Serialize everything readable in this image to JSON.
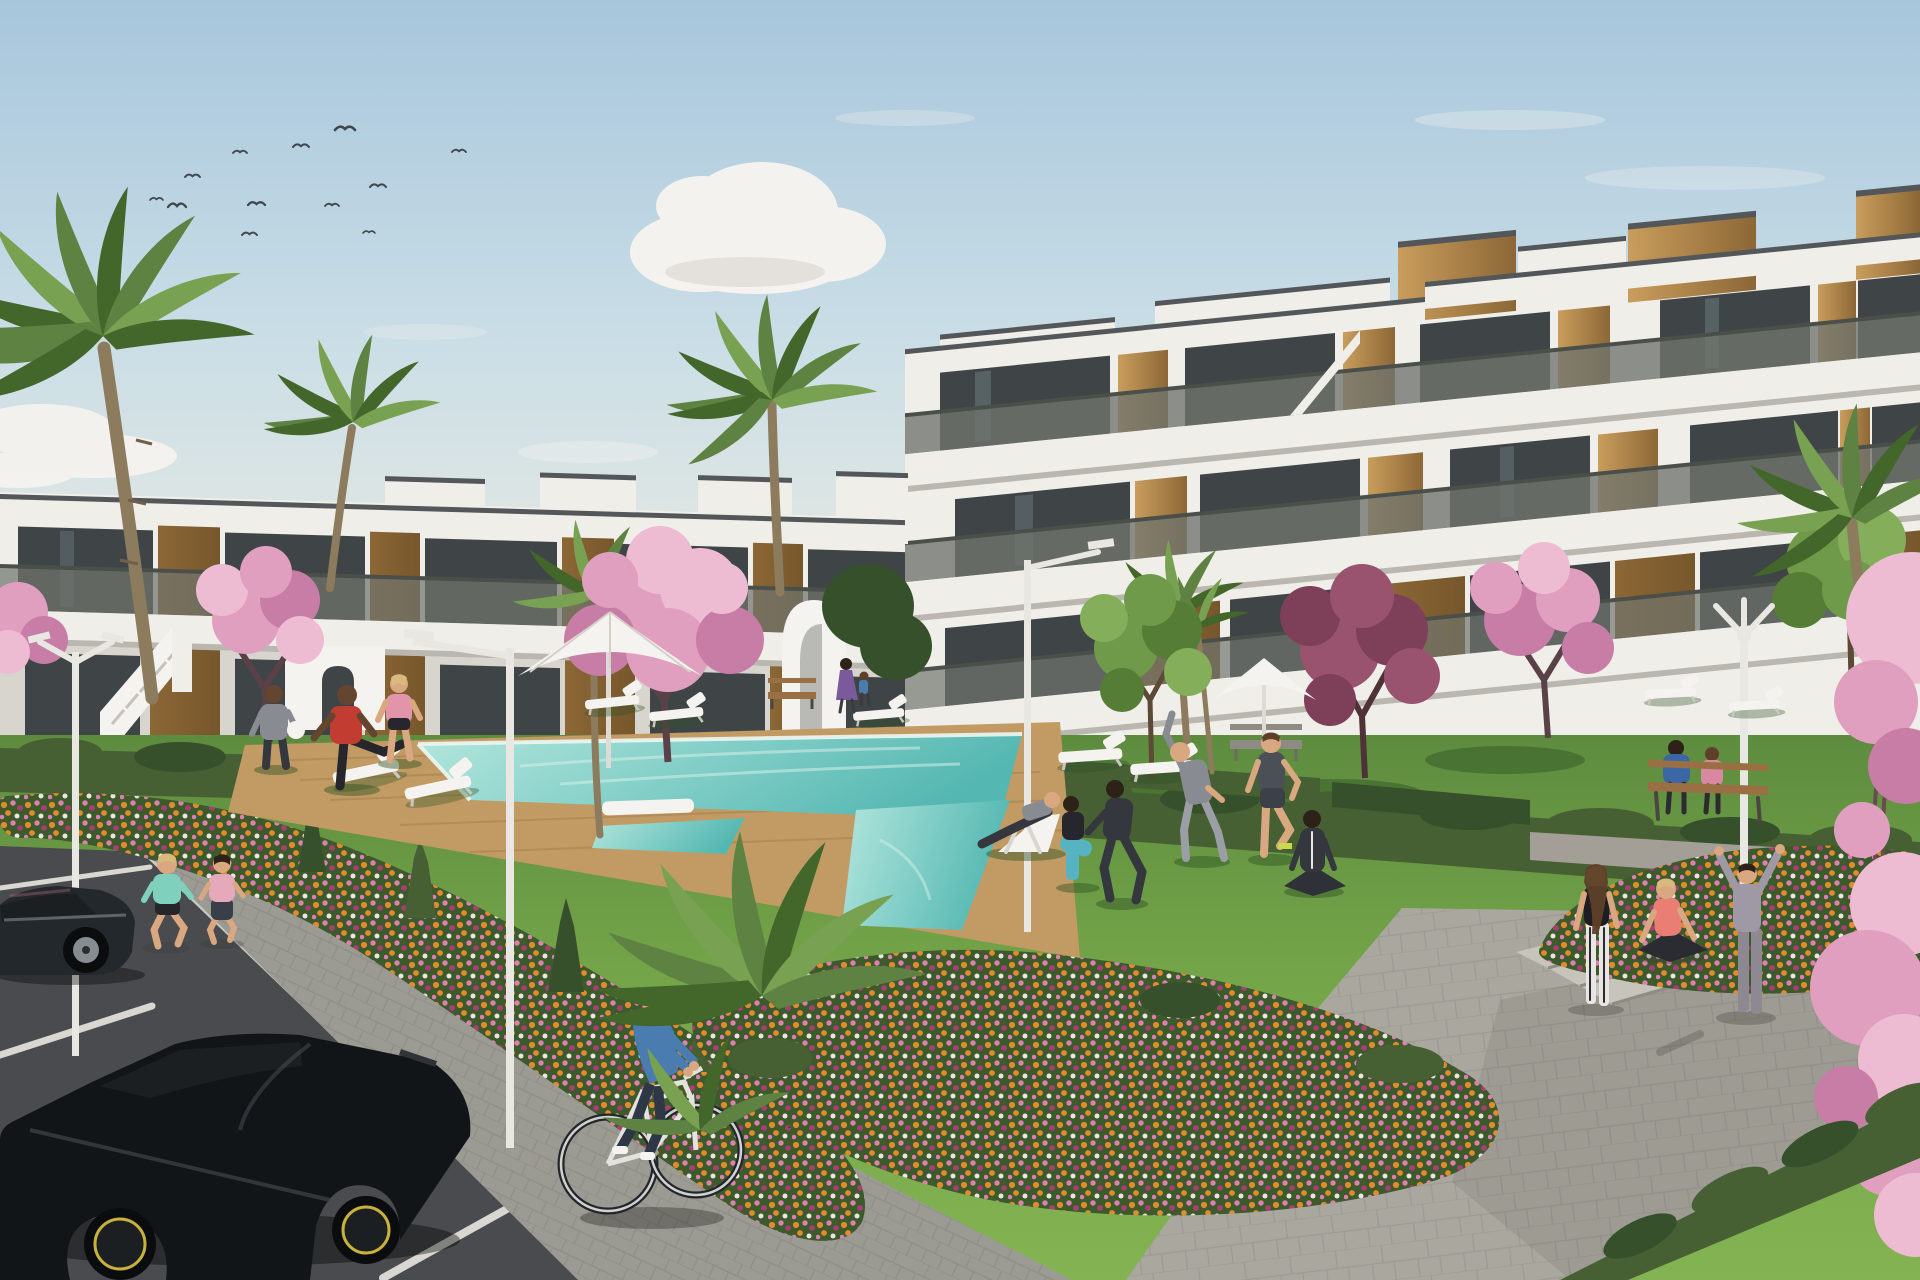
{
  "scene": {
    "type": "photorealistic 3D architectural rendering (real-estate visualization)",
    "description": "Modern white Mediterranean apartment complex: a 3-storey block on the right and a 2-storey terraced block on the left with wood-clad accents, glass balustrades and large tinted windows. Central landscaped garden with turquoise swimming pool and timber deck, white sun loungers and parasols, lawns where residents exercise, pink blossom trees, palm trees, flower beds of orange/pink/magenta blooms, white designer street lamps, a paved plaza on the right, and a parking road bottom-left with two dark cars, two joggers and a man cycling. Blue sky with small clouds and a flock of birds top-left.",
    "visible_text": [],
    "objects": {
      "buildings": {
        "right_block": {
          "storeys": 3,
          "style": "white modern, staggered balconies, glass balustrades, vertical wood cladding, rooftop wood-clad volumes, stepped stair parapets"
        },
        "left_block": {
          "storeys": 2,
          "style": "white terraced apartments, wood cladding, external white staircase, curved white arch stair tower"
        }
      },
      "pool": {
        "shape": "large rectangle with lower splash arm",
        "water": "turquoise",
        "surround": "timber deck",
        "accessory": "white pool-side board"
      },
      "vegetation": {
        "palm_trees": 7,
        "pink_blossom_trees": 5,
        "burgundy_tree": 1,
        "green_trees": 2,
        "flower_beds": 3,
        "hedge_rows": 6,
        "flower_colors": [
          "orange",
          "pink",
          "magenta",
          "white"
        ]
      },
      "people": {
        "total": 19,
        "activities": [
          "jogging (2 women)",
          "cycling (1 man)",
          "stretching and yoga group on lawn (6)",
          "walking (2)",
          "man holding ball",
          "man in deck chair",
          "3 women at plaza steps",
          "couple on wooden bench",
          "mother with child"
        ]
      },
      "vehicles": {
        "parked_cars": 2,
        "car_colors": [
          "dark graphite sedan",
          "black hot-hatch with yellow rim accents"
        ],
        "bicycles": 1
      },
      "furniture": {
        "sun_loungers": 9,
        "parasols": 2,
        "benches": 3,
        "street_lamps": 4
      },
      "birds_in_sky": 12
    }
  },
  "palette": {
    "sky_top": "#a7c6dc",
    "sky_mid": "#c9dde6",
    "sky_low": "#e6e9e3",
    "cloud": "#f7f4f0",
    "cloud_shade": "#d9d4ce",
    "bird": "#3d474c",
    "bldg_white": "#f0eee9",
    "bldg_shade": "#d8d4ce",
    "bldg_dark_trim": "#53575a",
    "slab_shadow": "#bab7b0",
    "glass": "#3f4547",
    "glass_reflect": "#8fa4ab",
    "balustrade": "#70756e",
    "rail": "#4b4f4a",
    "wood_light": "#c99d5c",
    "wood_dark": "#8c6736",
    "wood_shade": "#76572c",
    "hedge": "#466034",
    "hedge_dark": "#35502a",
    "grass_top": "#5e8c3f",
    "grass_mid": "#74a549",
    "grass_bright": "#83b352",
    "shadow_grass": "#2f5124",
    "deck": "#c19b63",
    "deck_dark": "#9d7b4a",
    "pool_light": "#b3e6dc",
    "pool_main": "#7fcdc6",
    "pool_deep": "#55b7b1",
    "road": "#4a4b4e",
    "road_line": "#d8d7d1",
    "walk": "#9b9a93",
    "paver_line": "#878680",
    "plaza": "#aaa79f",
    "step": "#c7c4bc",
    "bed_green": "#3d5a2d",
    "fl_orange": "#e28a2e",
    "fl_pink": "#de7fae",
    "fl_magenta": "#a93e74",
    "fl_white": "#ece4e0",
    "blossom1": "#eebcd2",
    "blossom2": "#e09fbe",
    "blossom3": "#c87da6",
    "burgundy1": "#9a536e",
    "burgundy2": "#7e3f58",
    "leaf1": "#6f9a4a",
    "leaf2": "#557d36",
    "leaf3": "#84ae5a",
    "palm1": "#5d8242",
    "palm2": "#43662a",
    "palm3": "#78a251",
    "trunk": "#8d7b5e",
    "trunk_dark": "#6f6049",
    "lamp": "#e9e7e1",
    "white": "#f4f3ef",
    "skin": "#d9a880",
    "skin_dark": "#64452f",
    "hair_blonde": "#d9b97e",
    "hair_brown": "#5e4028",
    "hair_dark": "#2e2118",
    "mint_top": "#7fd0bd",
    "jog_pink": "#e6a9b9",
    "red_shirt": "#c33c31",
    "pink_top": "#e295aa",
    "blue_shirt": "#4a7cb0",
    "jeans": "#2e3746",
    "coral_top": "#ea7d74",
    "teal_leggings": "#56b4c2",
    "gray_suit": "#888c92",
    "gray_light": "#9b9ea4",
    "track_dark": "#34373e",
    "hoodie_gray": "#9e99a4",
    "purple_dress": "#7a5a9a",
    "blue_jacket": "#3b67a6",
    "bench_wood": "#9a6f44",
    "car_dark": "#23282c",
    "car_black": "#121517",
    "car_glass": "#1b1f22",
    "alloy": "#878c91",
    "rim_yellow": "#c8b23c"
  }
}
